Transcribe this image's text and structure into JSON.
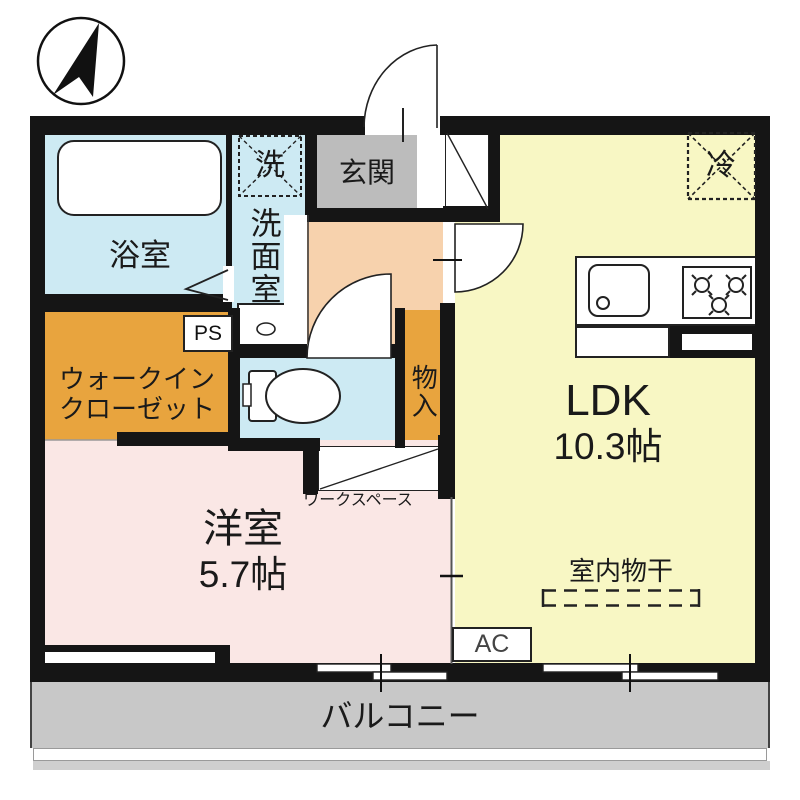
{
  "floorplan": {
    "compass": {
      "name": "north-arrow"
    },
    "rooms": {
      "bathroom": {
        "label": "浴室",
        "color": "#cdeaf3"
      },
      "washroom": {
        "label": "洗面室",
        "washer_symbol": "洗",
        "color": "#cdeaf3"
      },
      "genkan": {
        "label": "玄関",
        "color": "#bcbcbc"
      },
      "hallway": {
        "color": "#f7d2ad"
      },
      "walk_in_closet": {
        "label_line1": "ウォークイン",
        "label_line2": "クローゼット",
        "color": "#e8a43e"
      },
      "toilet": {
        "color": "#cdeaf3"
      },
      "storage": {
        "label": "物入",
        "color": "#e8a43e"
      },
      "bedroom": {
        "label": "洋室",
        "size": "5.7帖",
        "color": "#fae7e5"
      },
      "ldk": {
        "label": "LDK",
        "size": "10.3帖",
        "color": "#f8f7c4"
      },
      "workspace": {
        "label": "ワークスペース"
      },
      "balcony": {
        "label": "バルコニー",
        "color": "#c8c8c8"
      }
    },
    "annotations": {
      "pipe_space": "PS",
      "air_conditioner": "AC",
      "refrigerator": "冷",
      "indoor_drying": "室内物干"
    },
    "wall_color": "#151515"
  }
}
